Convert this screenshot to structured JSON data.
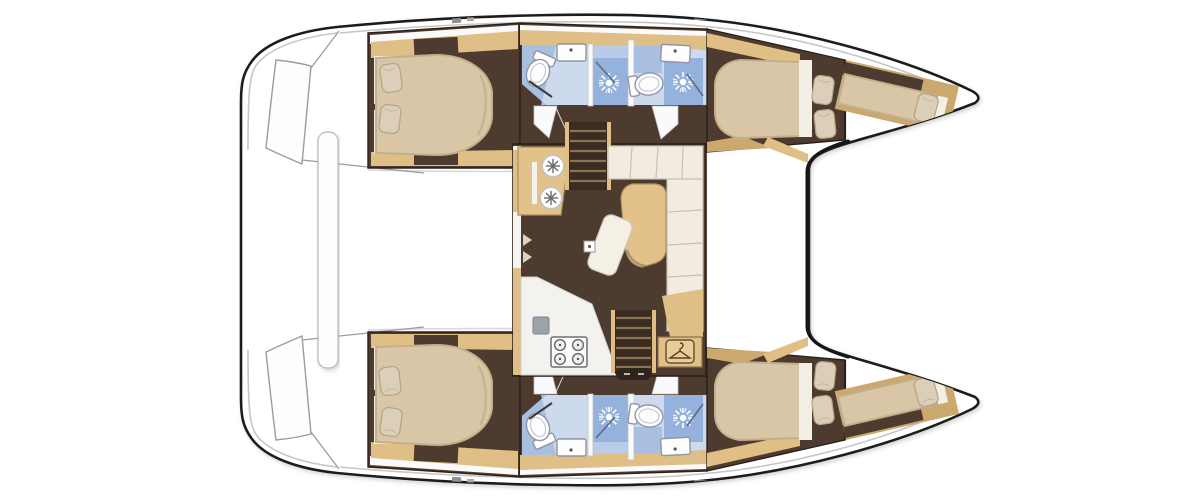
{
  "document": {
    "title": "Catamaran interior layout floor plan, top view",
    "type": "boat-floor-plan"
  },
  "colors": {
    "hull_outline": "#1f1f1f",
    "deck_white": "#ffffff",
    "deck_shadow": "#c7c7c7",
    "wood_tan": "#e0bf87",
    "wood_tan_dark": "#caa86e",
    "floor_brown": "#4e3b2f",
    "floor_brown_dark": "#3a2c21",
    "step_light": "#8d7355",
    "bed_beige": "#d8c6a6",
    "bed_shadow": "#c4af8c",
    "pillow": "#dbcfb9",
    "pillow_edge": "#b2a488",
    "linen_white": "#f3efe5",
    "sofa_cream": "#f1ecdf",
    "sofa_seam": "#c9c0ae",
    "table_wood": "#e2c28a",
    "bath_floor": "#cdd9ec",
    "bath_panel": "#a9bfdf",
    "shower_blue": "#94b2db",
    "fixture_white": "#fdfdfd",
    "fixture_edge": "#8f95a3",
    "appliance_gray": "#9aa2ab",
    "icon_brown": "#5a4327"
  },
  "areas": {
    "boat": "catamaran hull outline",
    "stern_platform": "aft platform with transom steps",
    "cockpit_bench": "aft cockpit bench",
    "hull_top": "starboard hull: aft double cabin, two shower bathrooms, forward double cabin, forepeak berth",
    "hull_bottom": "port hull: aft double cabin, two shower bathrooms, forward double cabin, forepeak berth",
    "saloon": "central saloon with galley, settee, table and stairs",
    "foredeck": "foredeck between bows"
  },
  "fixtures": {
    "icons": [
      "toilet-icon",
      "sink-icon",
      "shower-icon",
      "stove-icon",
      "hanger-icon",
      "stairs-icon",
      "twin-sink-icon"
    ],
    "saloon_items": [
      "twin round sinks unit",
      "L-shaped settee",
      "saloon table",
      "chaise seat",
      "galley counter",
      "four burner stove",
      "galley sink",
      "wardrobe with hanger",
      "companionway stairs starboard",
      "companionway stairs port"
    ],
    "cabin_items": [
      "island double bed",
      "two pillows",
      "side lockers",
      "forepeak single berth"
    ]
  }
}
